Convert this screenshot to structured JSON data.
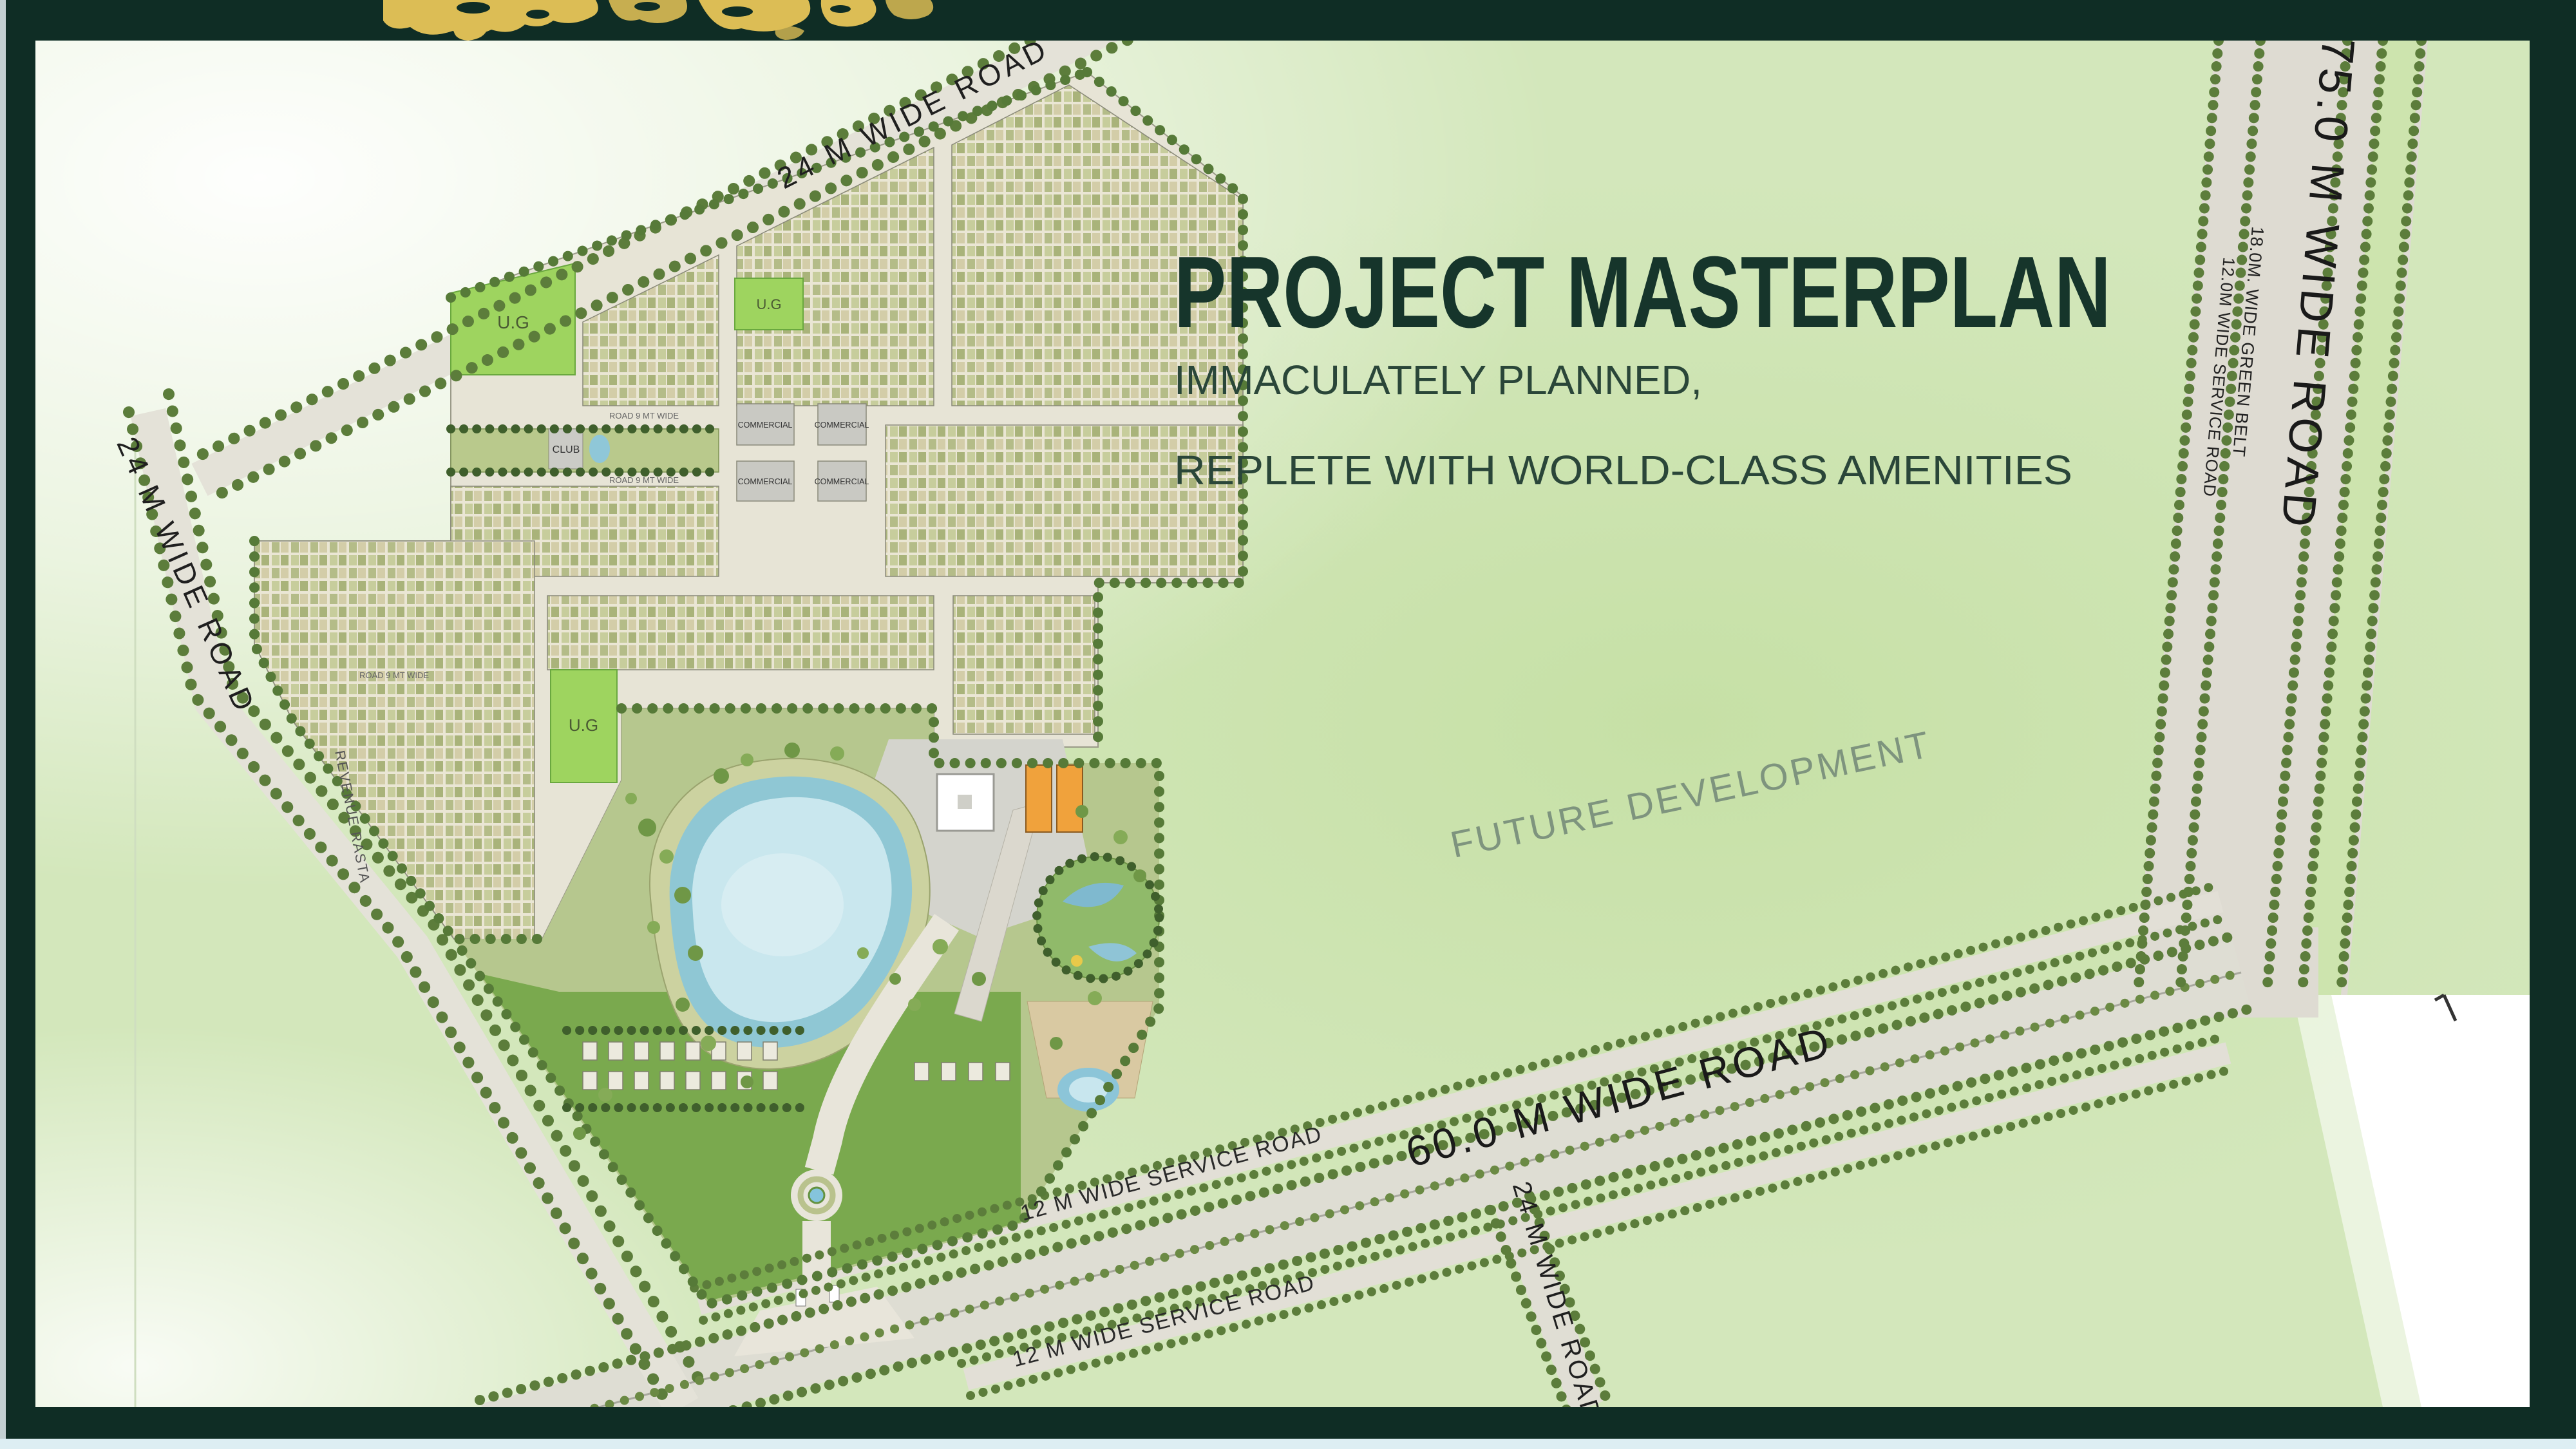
{
  "window": {
    "type": "presentation-slide-masterplan"
  },
  "header": {
    "globe_icon": "gold-world-map-fragment"
  },
  "title_block": {
    "title": "PROJECT MASTERPLAN",
    "subtitle_line1": "IMMACULATELY PLANNED,",
    "subtitle_line2": "REPLETE WITH WORLD-CLASS AMENITIES"
  },
  "map": {
    "future_area_label": "FUTURE DEVELOPMENT",
    "roads": {
      "r24": "24 M  WIDE ROAD",
      "r60": "60.0 M  WIDE ROAD",
      "r75": "75.0 M WIDE ROAD",
      "service12": "12 M  WIDE SERVICE ROAD",
      "green_belt": "18.0M. WIDE GREEN BELT",
      "service75": "12.0M  WIDE SERVICE ROAD"
    },
    "parcels": {
      "ug": "U.G",
      "club": "CLUB",
      "commercial": "COMMERCIAL",
      "revenue_rasta": "REVENUE RASTA",
      "internal_road": "ROAD 9 MT WIDE"
    },
    "colors": {
      "frame": "#0f2d25",
      "map_green": "#d3e7bb",
      "road_gray": "#e0ded4",
      "tree_green": "#5c7d3b",
      "water_blue": "#8fc7d4",
      "parcel_green": "#9ed45f",
      "commercial_orange": "#f0a23c",
      "title_green": "#16352b",
      "future_text": "#7e947e"
    }
  }
}
